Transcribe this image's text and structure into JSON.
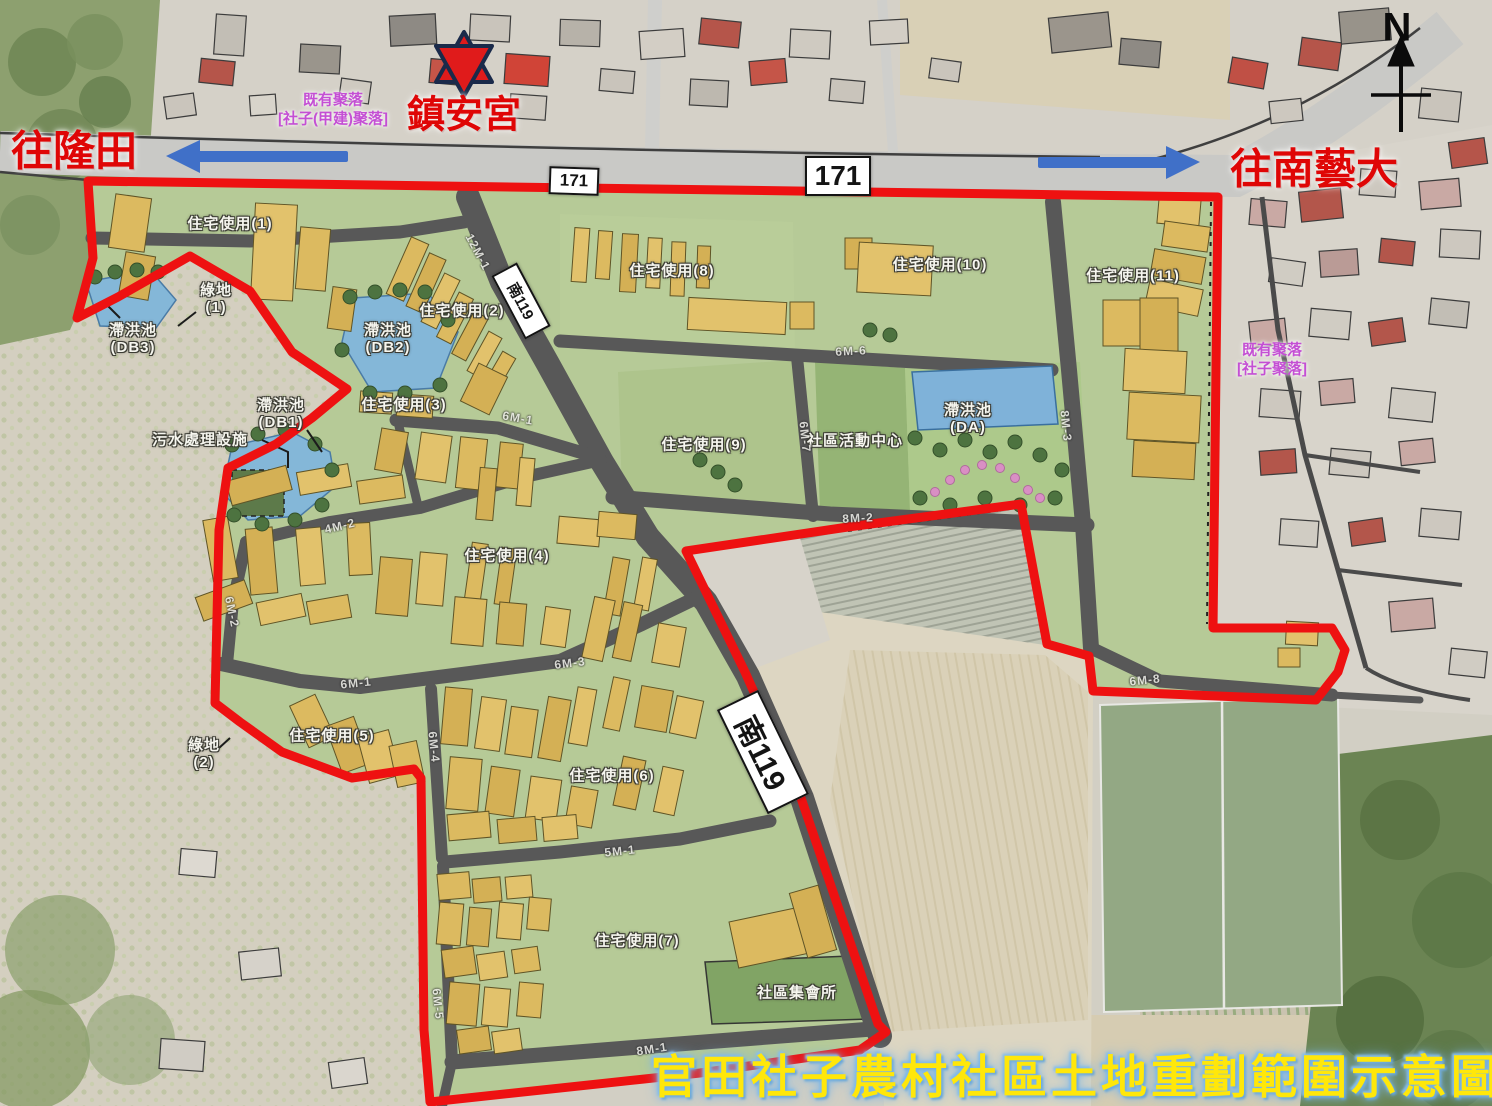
{
  "title": "官田社子農村社區土地重劃範圍示意圖",
  "compass_label": "N",
  "temple_name": "鎮安宮",
  "direction_left": "往隆田",
  "direction_right": "往南藝大",
  "badges": {
    "hwy171": "171",
    "nan119": "南119"
  },
  "clusters": {
    "jiajian_line1": "既有聚落",
    "jiajian_line2": "[社子(甲建)聚落]",
    "shezi_line1": "既有聚落",
    "shezi_line2": "[社子聚落]"
  },
  "zones": {
    "res1": "住宅使用(1)",
    "res2": "住宅使用(2)",
    "res3": "住宅使用(3)",
    "res4": "住宅使用(4)",
    "res5": "住宅使用(5)",
    "res6": "住宅使用(6)",
    "res7": "住宅使用(7)",
    "res8": "住宅使用(8)",
    "res9": "住宅使用(9)",
    "res10": "住宅使用(10)",
    "res11": "住宅使用(11)",
    "green1_line1": "綠地",
    "green1_line2": "(1)",
    "green2_line1": "綠地",
    "green2_line2": "(2)",
    "db1_line1": "滯洪池",
    "db1_line2": "(DB1)",
    "db2_line1": "滯洪池",
    "db2_line2": "(DB2)",
    "db3_line1": "滯洪池",
    "db3_line2": "(DB3)",
    "da_line1": "滯洪池",
    "da_line2": "(DA)",
    "sewage": "污水處理設施",
    "activity_center": "社區活動中心",
    "assembly_hall": "社區集會所"
  },
  "road_labels": {
    "m12_1": "12M-1",
    "m6_1": "6M-1",
    "m6_2": "6M-2",
    "m6_3": "6M-3",
    "m6_4": "6M-4",
    "m6_5": "6M-5",
    "m6_6": "6M-6",
    "m6_7": "6M-7",
    "m6_8": "6M-8",
    "m8_1": "8M-1",
    "m8_2": "8M-2",
    "m8_3": "8M-3",
    "m5_1": "5M-1",
    "m4_2": "4M-2"
  },
  "colors": {
    "boundary": "#ee1111",
    "grass": "#b6ca97",
    "road": "#585858",
    "pond": "#84b7d8",
    "building": "#dcba60",
    "arrow": "#4070c8",
    "title_text": "#ffe70a",
    "cluster_text": "#c44fd4"
  }
}
